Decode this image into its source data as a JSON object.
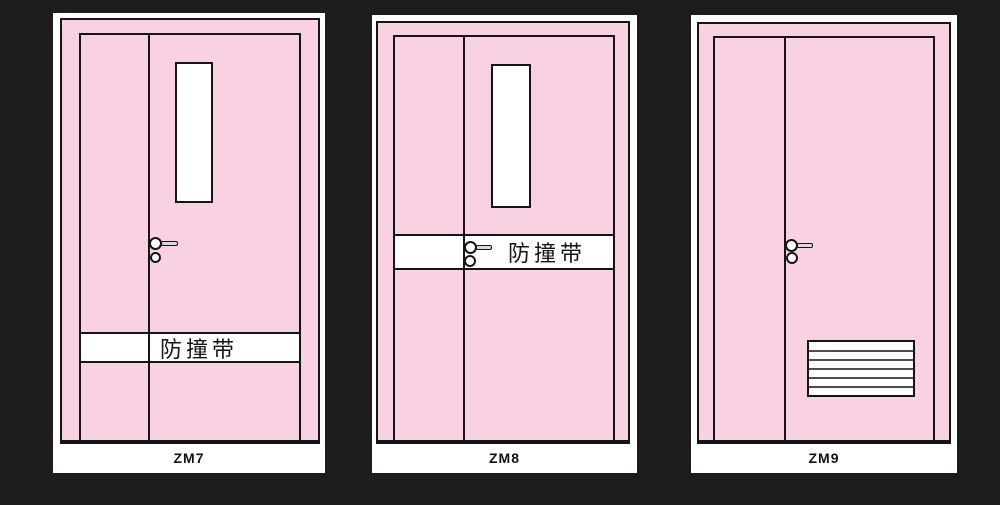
{
  "colors": {
    "background": "#1e1c1d",
    "card": "#ffffff",
    "door_fill": "#f8d2e2",
    "outline": "#151515",
    "louver_slat": "#4d4d4d",
    "handle_fill": "#d9d9d9",
    "label_text": "#111111"
  },
  "icons": {
    "lever_handle": "circle-with-horizontal-bar (css shapes)",
    "lock_cylinder": "outlined-circle (css shape)",
    "louver_vent": "rectangle-with-horizontal-slat-lines (css shapes)"
  },
  "doors": [
    {
      "code": "ZM7",
      "bump_strip_label": "防撞带"
    },
    {
      "code": "ZM8",
      "bump_strip_label": "防撞带"
    },
    {
      "code": "ZM9"
    }
  ]
}
